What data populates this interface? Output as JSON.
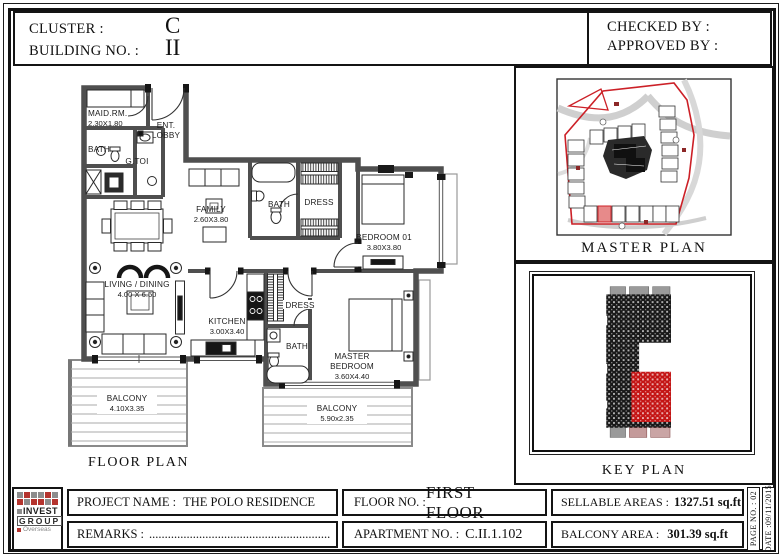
{
  "sheet": {
    "header": {
      "cluster_label": "CLUSTER :",
      "cluster_value": "C",
      "building_label": "BUILDING NO. :",
      "building_value": "II",
      "checked_by": "CHECKED BY :",
      "approved_by": "APPROVED BY :"
    },
    "floor_plan": {
      "caption": "FLOOR PLAN",
      "rooms": {
        "maid": {
          "name": "MAID.RM.",
          "dims": "2.30X1.80"
        },
        "ent_lobby": {
          "line1": "ENT.",
          "line2": "LOBBY"
        },
        "bath_maid": {
          "name": "BATH"
        },
        "gtoi": {
          "name": "G.TOI"
        },
        "family": {
          "name": "FAMILY",
          "dims": "2.60X3.80"
        },
        "bath_family": {
          "name": "BATH"
        },
        "dress_bed01": {
          "name": "DRESS"
        },
        "bedroom01": {
          "name": "BEDROOM 01",
          "dims": "3.80X3.80"
        },
        "living": {
          "name": "LIVING / DINING",
          "dims": "4.00 X 6.50"
        },
        "kitchen": {
          "name": "KITCHEN",
          "dims": "3.00X3.40"
        },
        "dress_master": {
          "name": "DRESS"
        },
        "bath_master": {
          "name": "BATH"
        },
        "master_bedroom": {
          "line1": "MASTER",
          "line2": "BEDROOM",
          "dims": "3.60X4.40"
        },
        "balcony_left": {
          "name": "BALCONY",
          "dims": "4.10X3.35"
        },
        "balcony_right": {
          "name": "BALCONY",
          "dims": "5.90x2.35"
        }
      }
    },
    "side_panel": {
      "master_plan_label": "MASTER PLAN",
      "key_plan_label": "KEY PLAN"
    },
    "title_block": {
      "project_label": "PROJECT NAME :",
      "project_value": "THE POLO RESIDENCE",
      "remarks_label": "REMARKS :",
      "remarks_value": "..........................................................",
      "floor_label": "FLOOR NO. :",
      "floor_value": "FIRST FLOOR",
      "apartment_label": "APARTMENT NO. :",
      "apartment_value": "C.II.1.102",
      "sellable_label": "SELLABLE AREAS :",
      "sellable_value": "1327.51 sq.ft",
      "balcony_label": "BALCONY AREA :",
      "balcony_value": "301.39 sq.ft",
      "page_no": "PAGE NO. :  02",
      "date": "DATE :09/11/2015"
    },
    "logo": {
      "line1": "INVEST",
      "line2": "GROUP",
      "line3": "Overseas"
    },
    "colors": {
      "wall": "#4f4f4f",
      "accent_red": "#cc2027",
      "logo_red": "#b5342e",
      "logo_gray": "#8d8d8d"
    }
  }
}
